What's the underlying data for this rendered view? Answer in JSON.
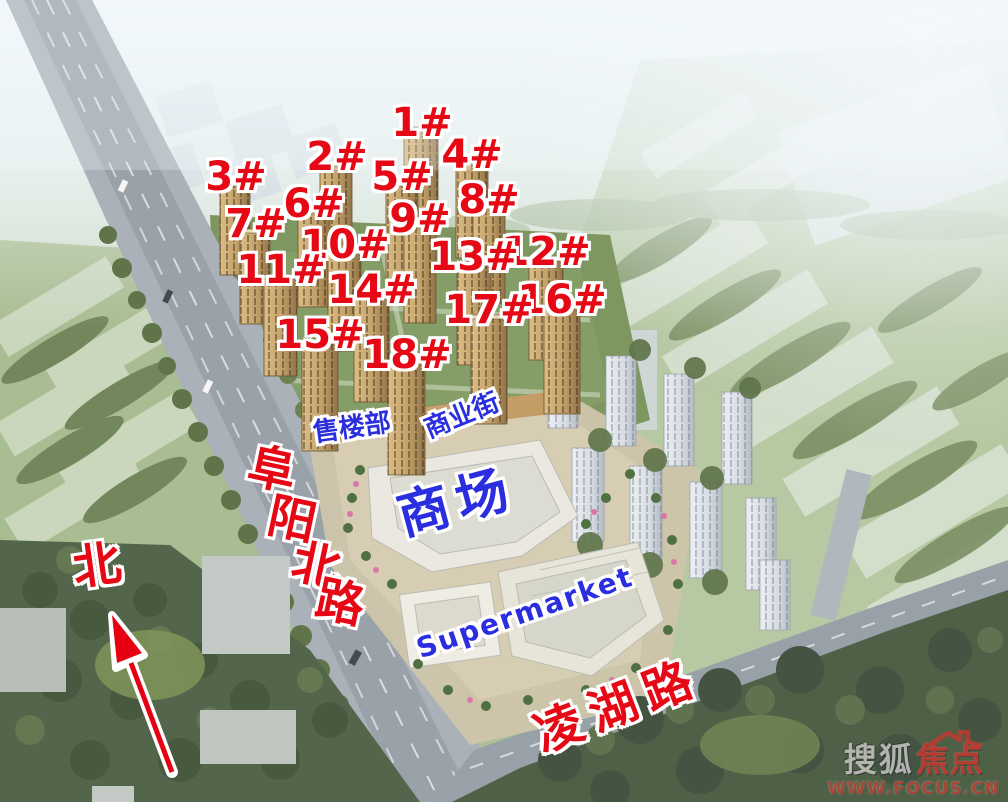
{
  "colors": {
    "label_red": "#e60915",
    "label_blue": "#2b2ede",
    "watermark_red": "#c5372e"
  },
  "buildings": [
    {
      "label": "1#"
    },
    {
      "label": "2#"
    },
    {
      "label": "3#"
    },
    {
      "label": "4#"
    },
    {
      "label": "5#"
    },
    {
      "label": "6#"
    },
    {
      "label": "7#"
    },
    {
      "label": "8#"
    },
    {
      "label": "9#"
    },
    {
      "label": "10#"
    },
    {
      "label": "11#"
    },
    {
      "label": "12#"
    },
    {
      "label": "13#"
    },
    {
      "label": "14#"
    },
    {
      "label": "15#"
    },
    {
      "label": "16#"
    },
    {
      "label": "17#"
    },
    {
      "label": "18#"
    }
  ],
  "places": {
    "sales_office": "售楼部",
    "commercial_street": "商业街",
    "mall": "商场",
    "supermarket": "Supermarket"
  },
  "roads": {
    "fuyang_north": {
      "name": "阜阳北路",
      "chars": [
        "阜",
        "阳",
        "北",
        "路"
      ]
    },
    "linghu": {
      "name": "凌湖路"
    }
  },
  "compass": {
    "north_label": "北"
  },
  "watermark": {
    "brand_left": "搜狐",
    "brand_right": "焦点",
    "url": "WWW.FOCUS.CN"
  }
}
